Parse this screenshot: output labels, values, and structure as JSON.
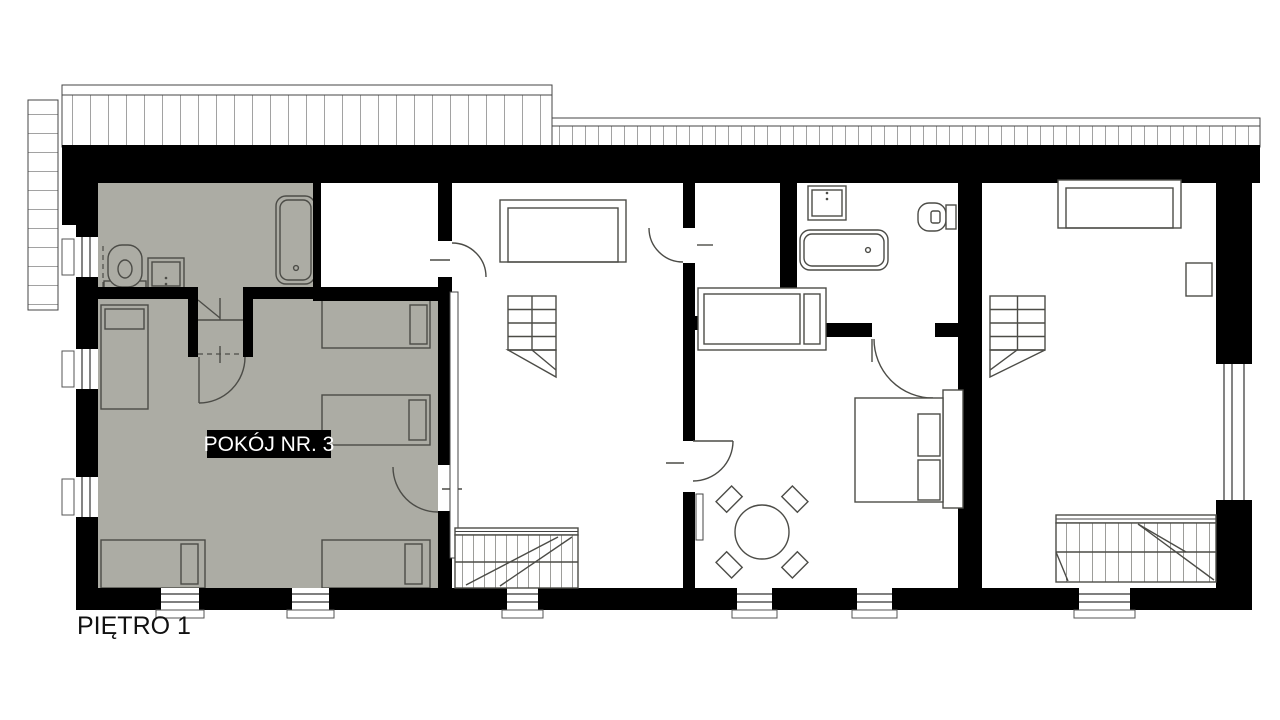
{
  "labels": {
    "floor": "PIĘTRO 1",
    "room": "POKÓJ NR. 3"
  },
  "colors": {
    "background": "#FFFFFF",
    "walls": "#000000",
    "highlight_room_fill": "#ACACA4",
    "furniture_stroke": "#4C4C47",
    "room_label_bg": "#000000",
    "room_label_text": "#FFFFFF",
    "floor_label_text": "#111111"
  },
  "fixtures": [
    "bathtub",
    "toilet",
    "sink",
    "single-bed",
    "double-bed",
    "staircase",
    "attic-ladder",
    "round-table",
    "chair",
    "roof-overhang",
    "window",
    "door-swing",
    "radiator"
  ]
}
